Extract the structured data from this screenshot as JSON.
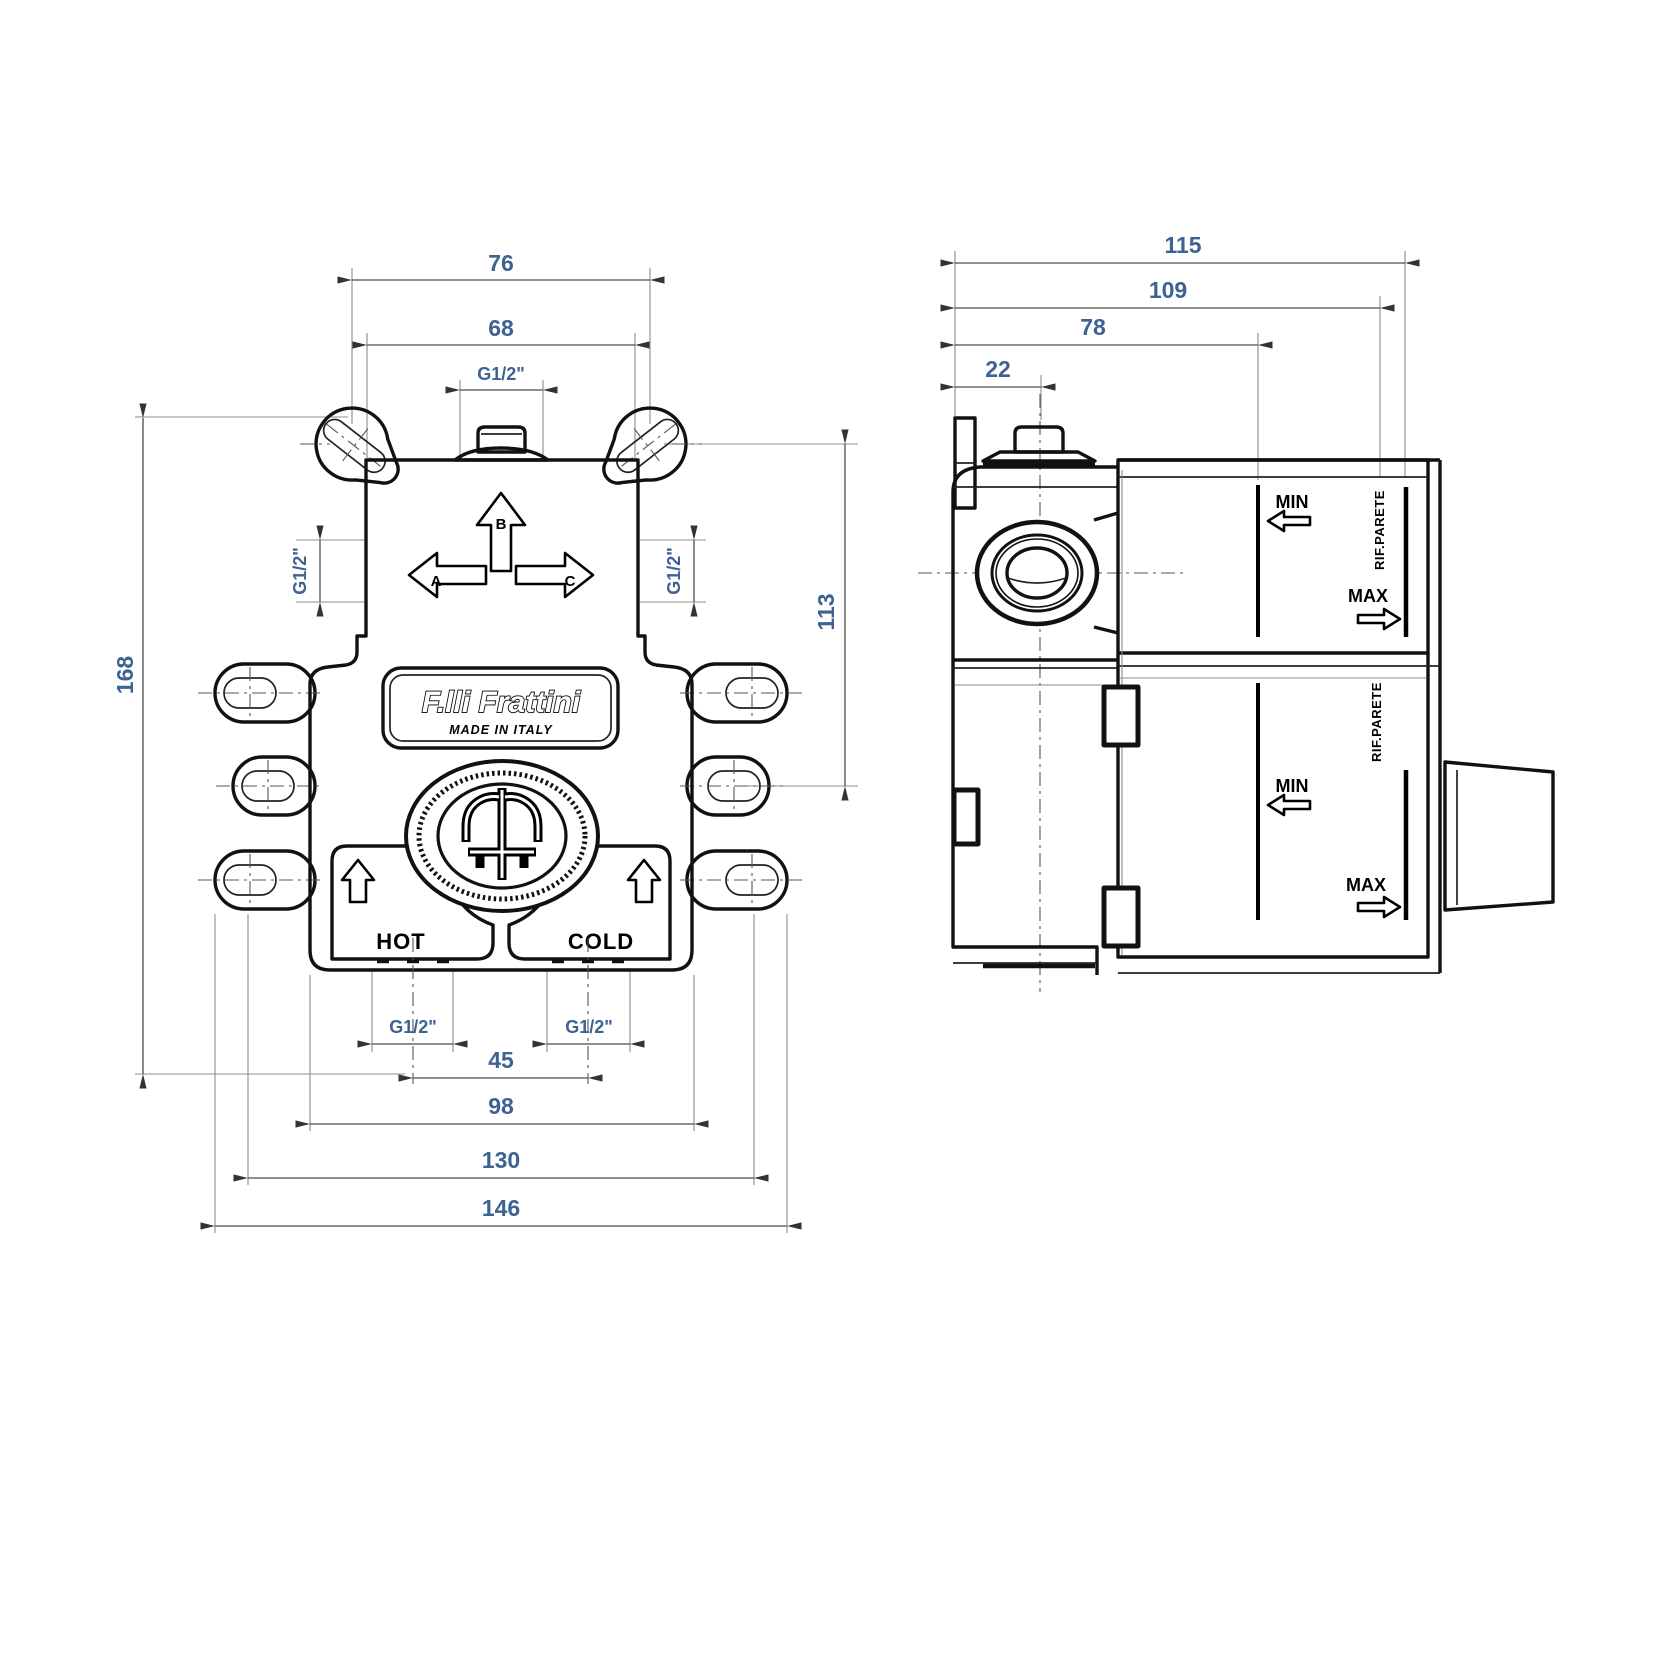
{
  "drawing_title": "concealed-mixer-valve-technical-drawing",
  "colors": {
    "line": "#111111",
    "dim_line": "#4d4d4d",
    "dim_text": "#3e6292",
    "background": "#ffffff"
  },
  "front": {
    "dims": {
      "top_hole_spacing": "76",
      "body_top_width": "68",
      "top_port_thread": "G1/2\"",
      "left_port_thread": "G1/2\"",
      "right_port_thread": "G1/2\"",
      "overall_height": "168",
      "side_height": "113",
      "hot_port_thread": "G1/2\"",
      "cold_port_thread": "G1/2\"",
      "bottom_port_spacing": "45",
      "body_bottom_width": "98",
      "tab_hole_spacing": "130",
      "overall_width": "146"
    },
    "labels": {
      "brand": "F.lli Frattini",
      "made_in": "MADE IN ITALY",
      "hot": "HOT",
      "cold": "COLD",
      "outlet_a": "A",
      "outlet_b": "B",
      "outlet_c": "C"
    }
  },
  "side": {
    "dims": {
      "depth_max": "115",
      "depth_reference": "109",
      "depth_min": "78",
      "top_port_offset": "22"
    },
    "labels": {
      "min_upper": "MIN",
      "max_upper": "MAX",
      "min_lower": "MIN",
      "max_lower": "MAX",
      "wall_ref_upper": "RIF.PARETE",
      "wall_ref_lower": "RIF.PARETE"
    }
  }
}
